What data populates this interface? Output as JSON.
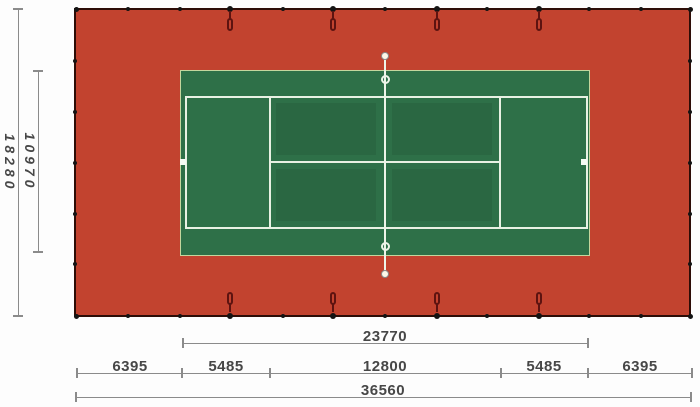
{
  "diagram": {
    "name": "Tennis court plan with dimensions",
    "dim_left_outer": "18280",
    "dim_left_inner": "10970",
    "dim_court_length": "23770",
    "dim_row": [
      "6395",
      "5485",
      "12800",
      "5485",
      "6395"
    ],
    "dim_total_length": "36560"
  },
  "colors": {
    "surface-red": "#c2432f",
    "surface-green": "#2e7048",
    "court-line": "#e8f1e3",
    "border-dark": "#2d0d07",
    "green-edge": "#c4d69e",
    "net-line": "#eef5e9",
    "dim-line": "#8b8b8b",
    "dim-text": "#474747",
    "post-black": "#141414",
    "tie-maroon": "#5d1310"
  }
}
